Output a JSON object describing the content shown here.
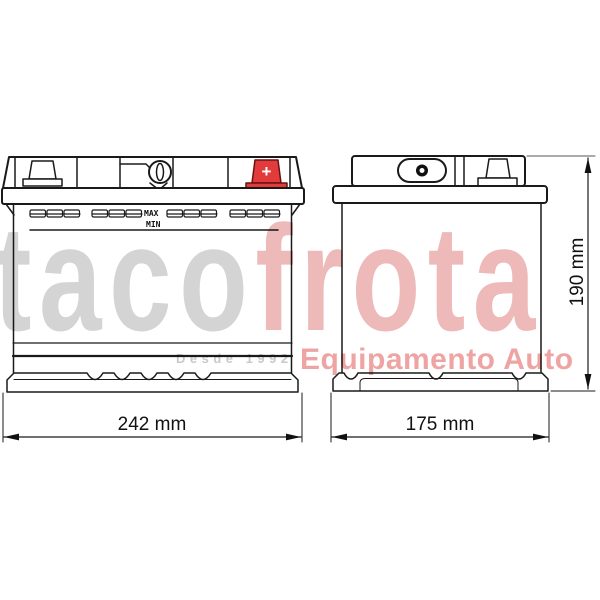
{
  "product_drawing": {
    "front_view": {
      "max_label": "MAX",
      "min_label": "MIN",
      "plus_symbol": "+",
      "width_label": "242 mm"
    },
    "side_view": {
      "width_label": "175 mm",
      "height_label": "190 mm"
    },
    "colors": {
      "terminal_red": "#e23b3b",
      "line": "#1a1a1a"
    }
  },
  "watermark": {
    "brand_part1": "taco",
    "brand_part2": "frota",
    "since": "Desde 1992",
    "tagline": "Equipamento Auto",
    "colors": {
      "brand_gray": "#d4d4d4",
      "brand_pink": "#edb9b9",
      "since_gray": "#c9c9c9",
      "tagline_pink": "#efa4a4"
    }
  }
}
